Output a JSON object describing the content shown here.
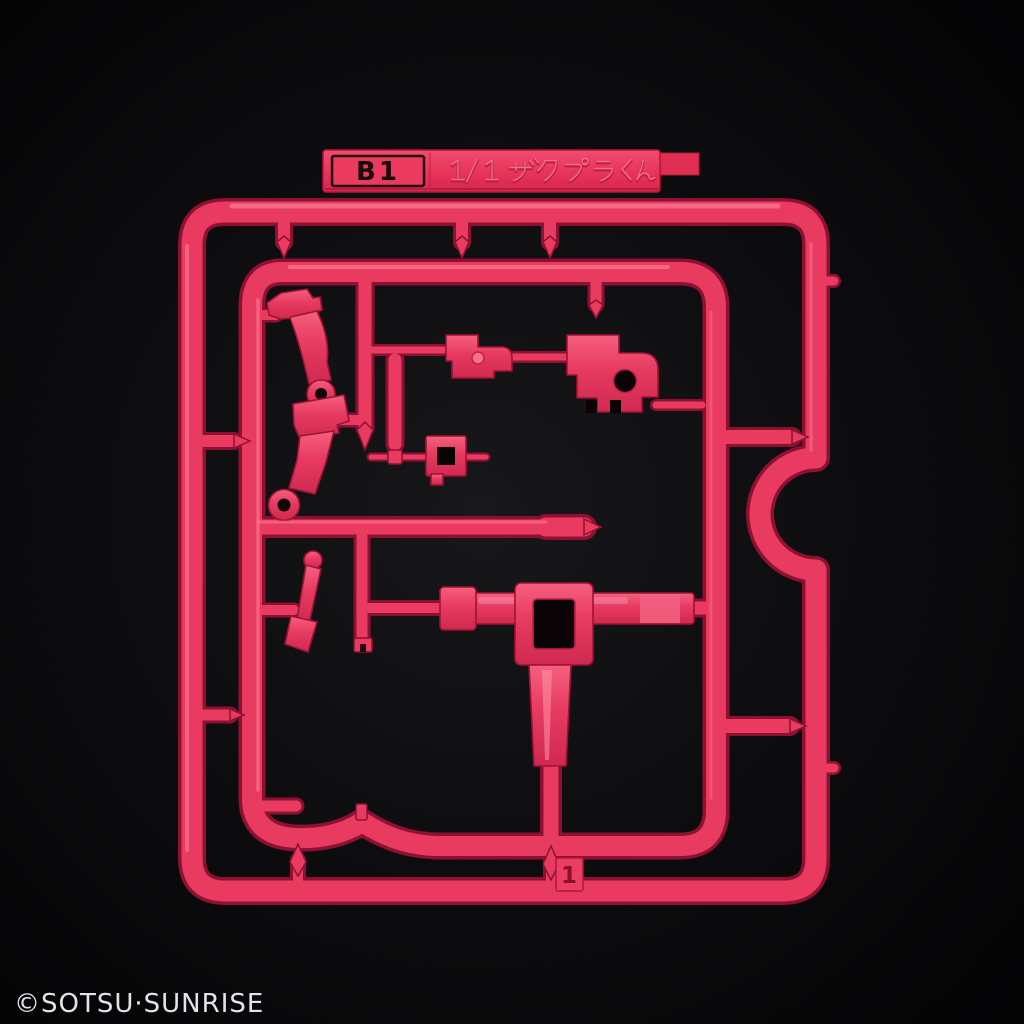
{
  "scene": {
    "description": "Product photo of a pink-red plastic model kit runner (sprue) on a black background",
    "background_color": "#050506",
    "plastic_color": "#e93b60"
  },
  "tag": {
    "runner_letter": "B1",
    "kit_name": "1/1 ザクプラくん"
  },
  "runner": {
    "gate_number": "1"
  },
  "footer": {
    "copyright": "©SOTSU·SUNRISE"
  }
}
